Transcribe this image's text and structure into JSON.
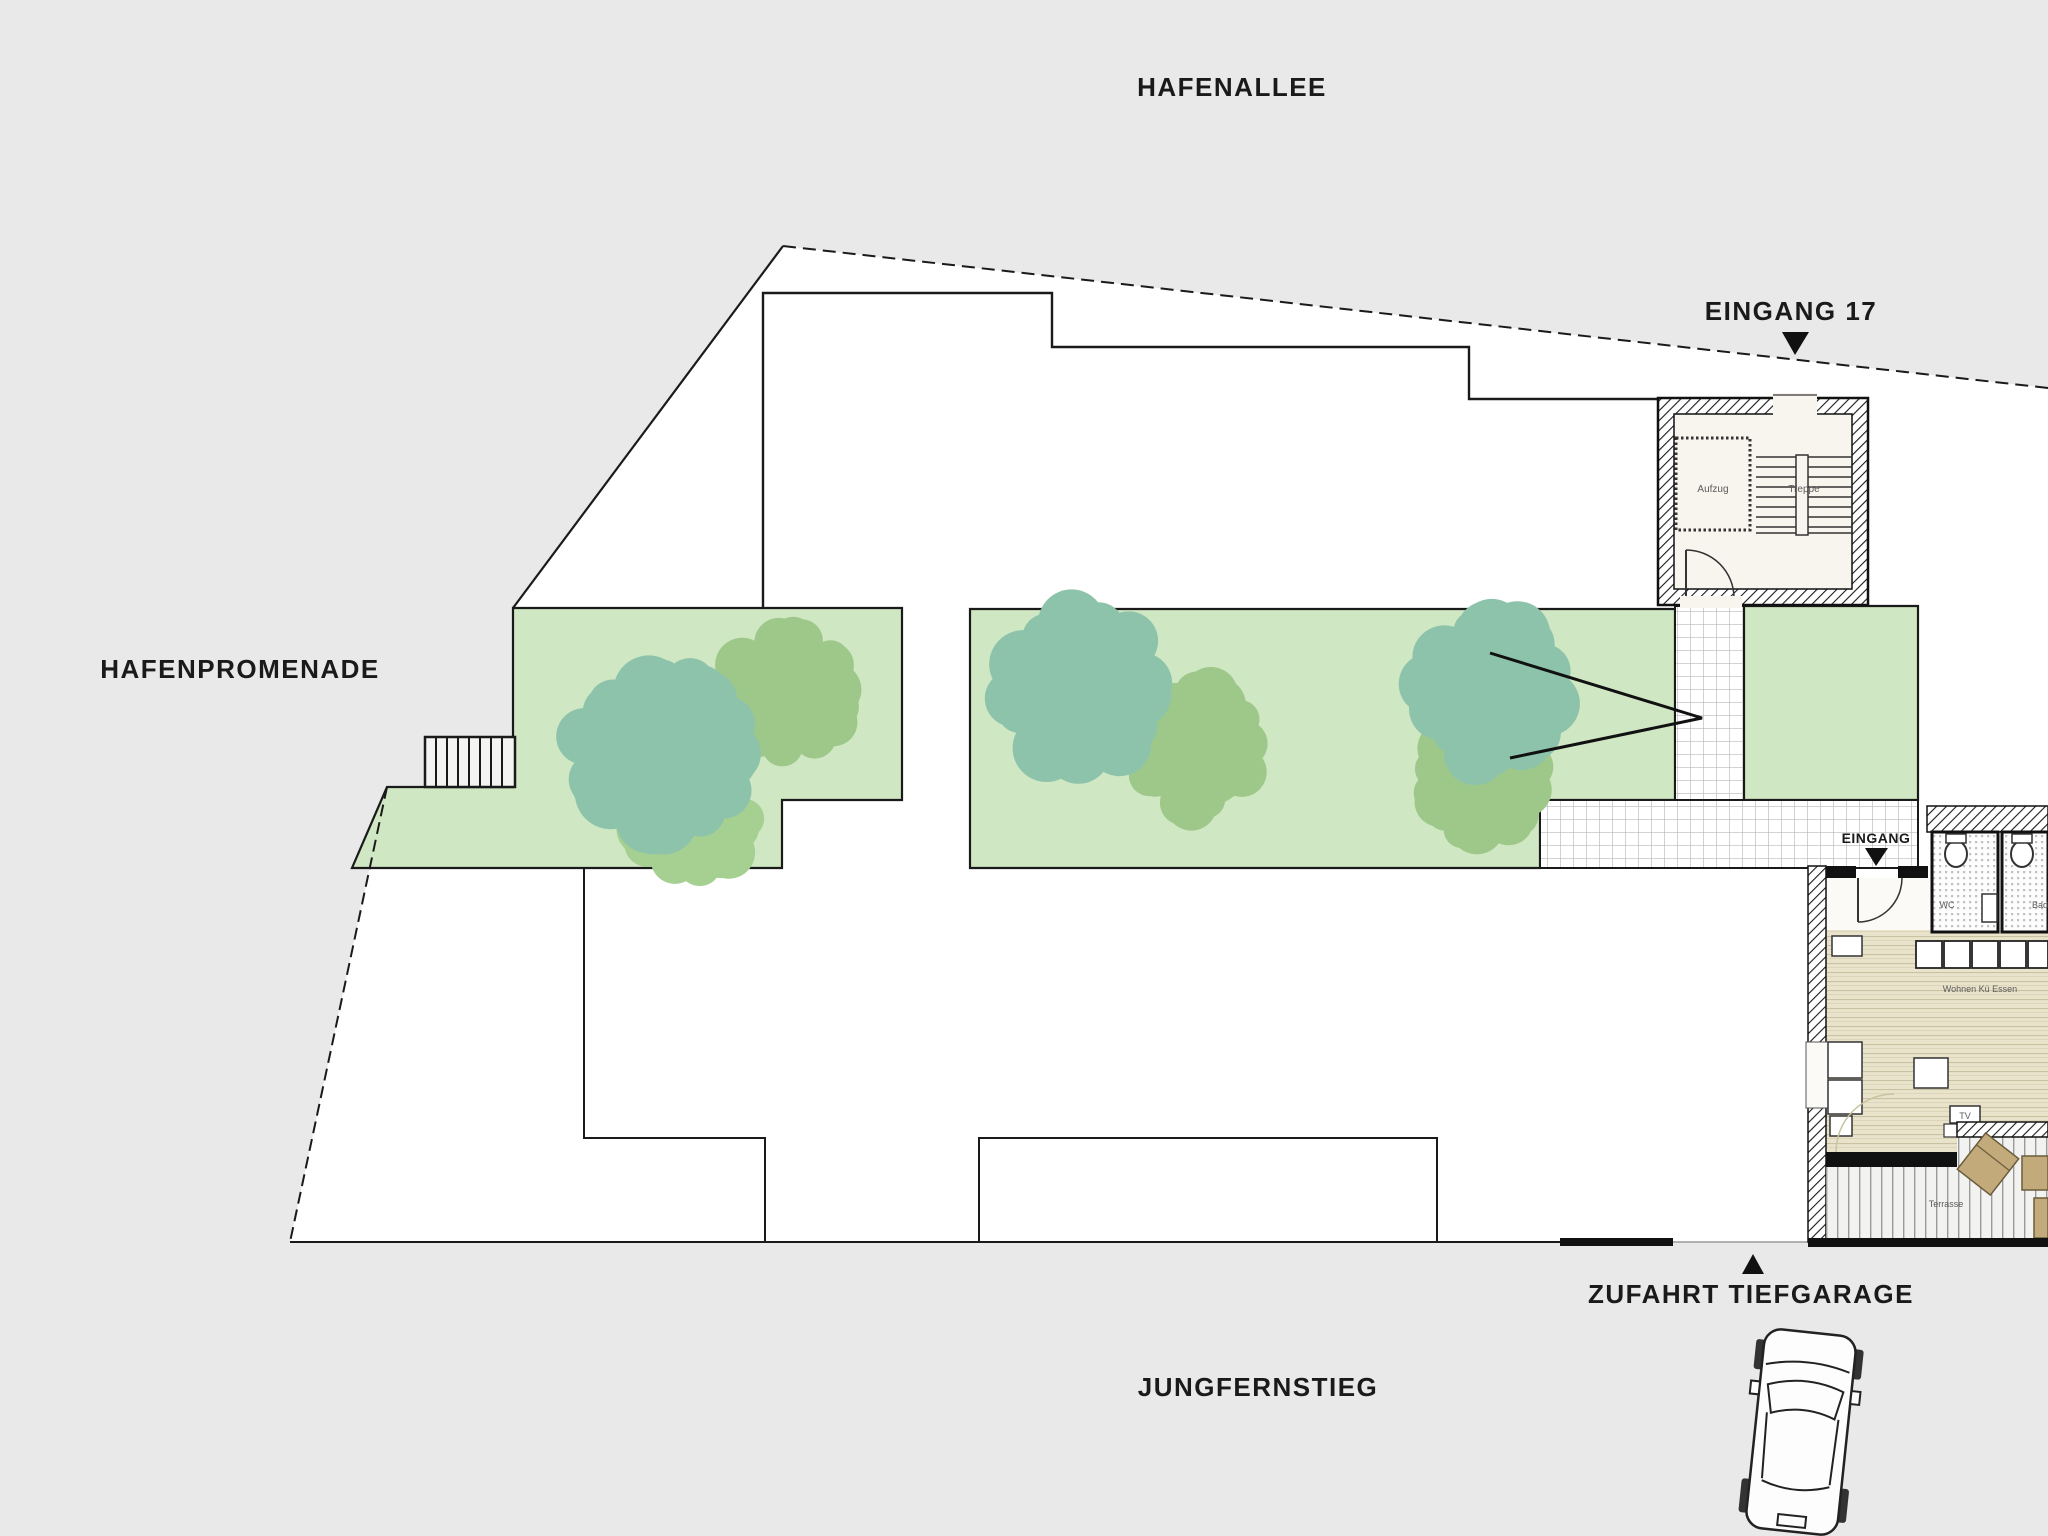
{
  "plan": {
    "streets": {
      "top": "HAFENALLEE",
      "left": "HAFENPROMENADE",
      "bottom": "JUNGFERNSTIEG"
    },
    "entrances": {
      "building": "EINGANG 17",
      "apartment": "EINGANG",
      "garage": "ZUFAHRT TIEFGARAGE"
    },
    "stairwell": {
      "elevator": "Aufzug",
      "stairs": "Treppe"
    },
    "apartment": {
      "wc": "WC",
      "bath": "Bad",
      "living": "Wohnen Kü Essen",
      "tv": "TV",
      "terrace": "Terrasse"
    },
    "colors": {
      "bg": "#e9e9e9",
      "site": "#ffffff",
      "green": "#cfe7c2",
      "tree_teal": "#8cc3aa",
      "tree_green": "#9ec88a",
      "tree_green2": "#a6d092",
      "line": "#1a1a1a",
      "interior": "#f7f5ee",
      "tan": "#c3aa7a"
    },
    "trees": [
      {
        "x": 788,
        "y": 690,
        "r": 72,
        "color": "tree_green",
        "seed": 3
      },
      {
        "x": 690,
        "y": 815,
        "r": 70,
        "color": "tree_green2",
        "seed": 5
      },
      {
        "x": 660,
        "y": 755,
        "r": 100,
        "color": "tree_teal",
        "seed": 7
      },
      {
        "x": 1197,
        "y": 748,
        "r": 74,
        "color": "tree_green",
        "seed": 11
      },
      {
        "x": 1077,
        "y": 688,
        "r": 92,
        "color": "tree_teal",
        "seed": 13
      },
      {
        "x": 1480,
        "y": 778,
        "r": 72,
        "color": "tree_green",
        "seed": 17
      },
      {
        "x": 1492,
        "y": 690,
        "r": 88,
        "color": "tree_teal",
        "seed": 19
      }
    ]
  }
}
